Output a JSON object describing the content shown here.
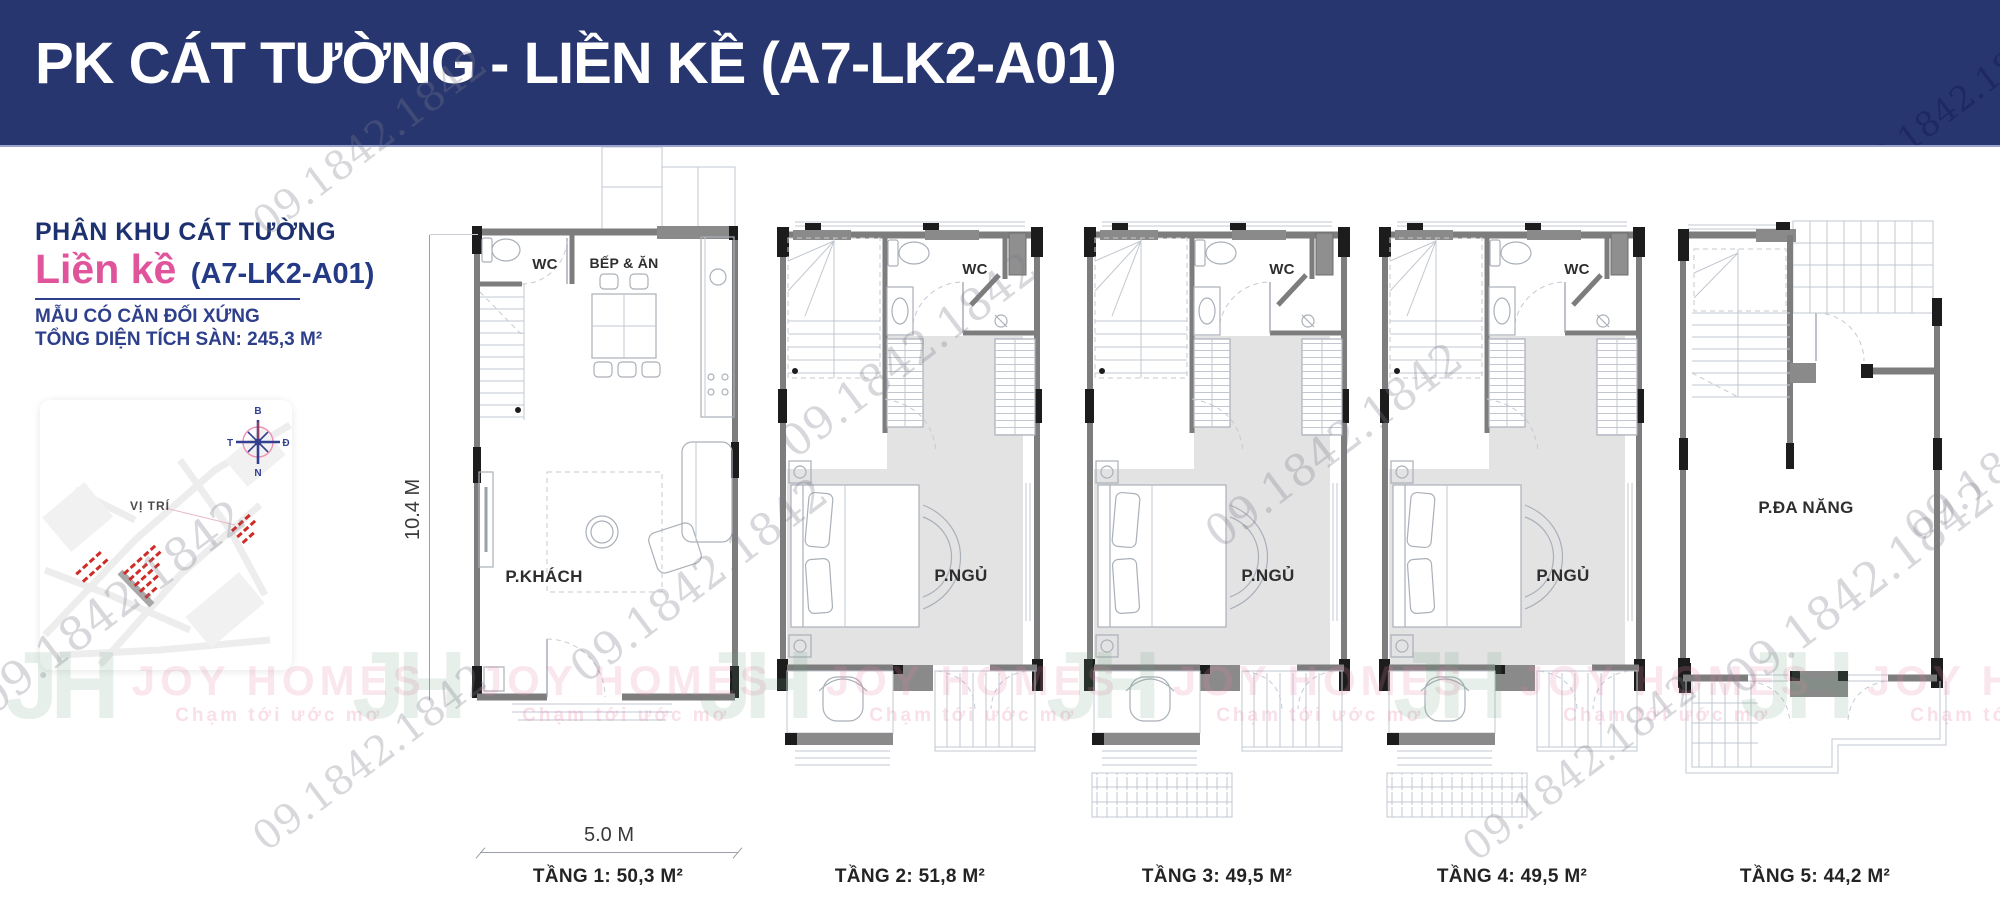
{
  "header": {
    "title": "PK CÁT TƯỜNG - LIỀN KỀ (A7-LK2-A01)"
  },
  "sidebar": {
    "subdivision": "PHÂN KHU CÁT TƯỜNG",
    "type_label": "Liền kề",
    "unit_code": "(A7-LK2-A01)",
    "note_symmetry": "MẪU CÓ CĂN ĐỐI XỨNG",
    "note_area": "TỔNG DIỆN TÍCH SÀN: 245,3 M²",
    "map": {
      "label": "VỊ TRÍ",
      "compass": {
        "north": "B",
        "east": "Đ",
        "south": "N",
        "west": "T"
      }
    }
  },
  "floors": [
    {
      "label": "TẦNG 1: 50,3 M²",
      "rooms": {
        "wc": "WC",
        "kitchen": "BẾP & ĂN",
        "living": "P.KHÁCH"
      },
      "dims": {
        "depth": "10.4 M",
        "width": "5.0 M"
      }
    },
    {
      "label": "TẦNG 2: 51,8 M²",
      "rooms": {
        "wc": "WC",
        "bedroom": "P.NGỦ"
      }
    },
    {
      "label": "TẦNG 3: 49,5 M²",
      "rooms": {
        "wc": "WC",
        "bedroom": "P.NGỦ"
      }
    },
    {
      "label": "TẦNG 4: 49,5 M²",
      "rooms": {
        "wc": "WC",
        "bedroom": "P.NGỦ"
      }
    },
    {
      "label": "TẦNG 5: 44,2 M²",
      "rooms": {
        "multi": "P.ĐA NĂNG"
      }
    }
  ],
  "watermarks": {
    "phone": "09.1842.1842",
    "brand_initials": "JH",
    "brand_name": "JOY HOMES",
    "tagline": "Chạm tới ước mơ"
  },
  "colors": {
    "header_bg": "#28366f",
    "accent_pink": "#e0549b",
    "accent_blue": "#2e3f8c",
    "wall_gray": "#7d7d7d",
    "floor_shade": "#e3e3e4",
    "cluster_red": "#cf2b27"
  }
}
